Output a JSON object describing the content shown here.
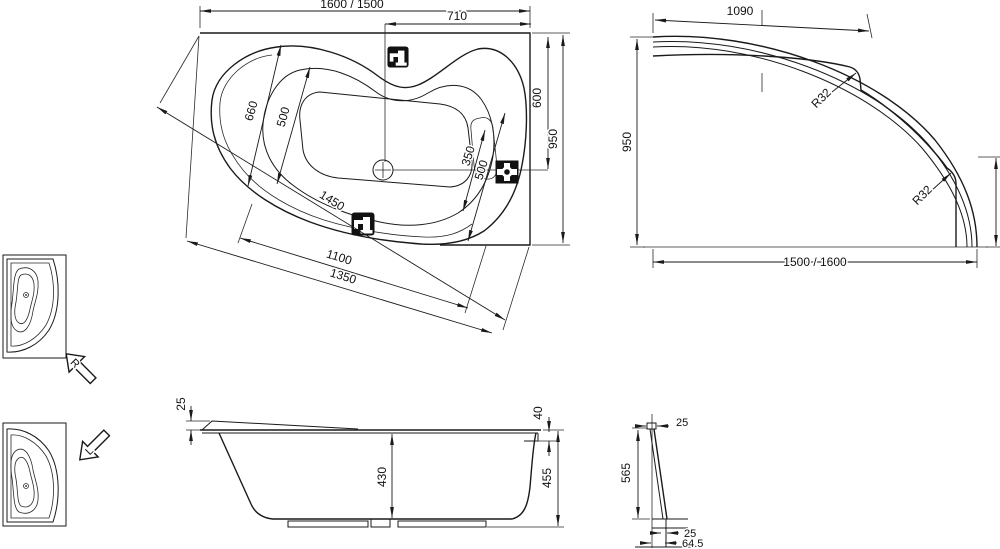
{
  "plan": {
    "length": "1600 / 1500",
    "tap_offset": "710",
    "width_outer": "660",
    "width_inner": "500",
    "seat_350": "350",
    "seat_500": "500",
    "diag": "1450",
    "front_inner": "1100",
    "front_outer": "1350",
    "side_600": "600",
    "side_950": "950"
  },
  "apron": {
    "top_edge": "1090",
    "height": "950",
    "r_top": "R32",
    "r_bottom": "R32",
    "length": "1500 / 1600"
  },
  "section": {
    "rim25": "25",
    "edge40": "40",
    "depth430": "430",
    "height455": "455"
  },
  "panel": {
    "top25": "25",
    "h565": "565",
    "foot25": "25",
    "base645": "64.5"
  },
  "variants": {
    "r": "R",
    "l": "L"
  },
  "colors": {
    "line": "#1a1a1a",
    "icon": "#111111",
    "background": "#ffffff"
  }
}
